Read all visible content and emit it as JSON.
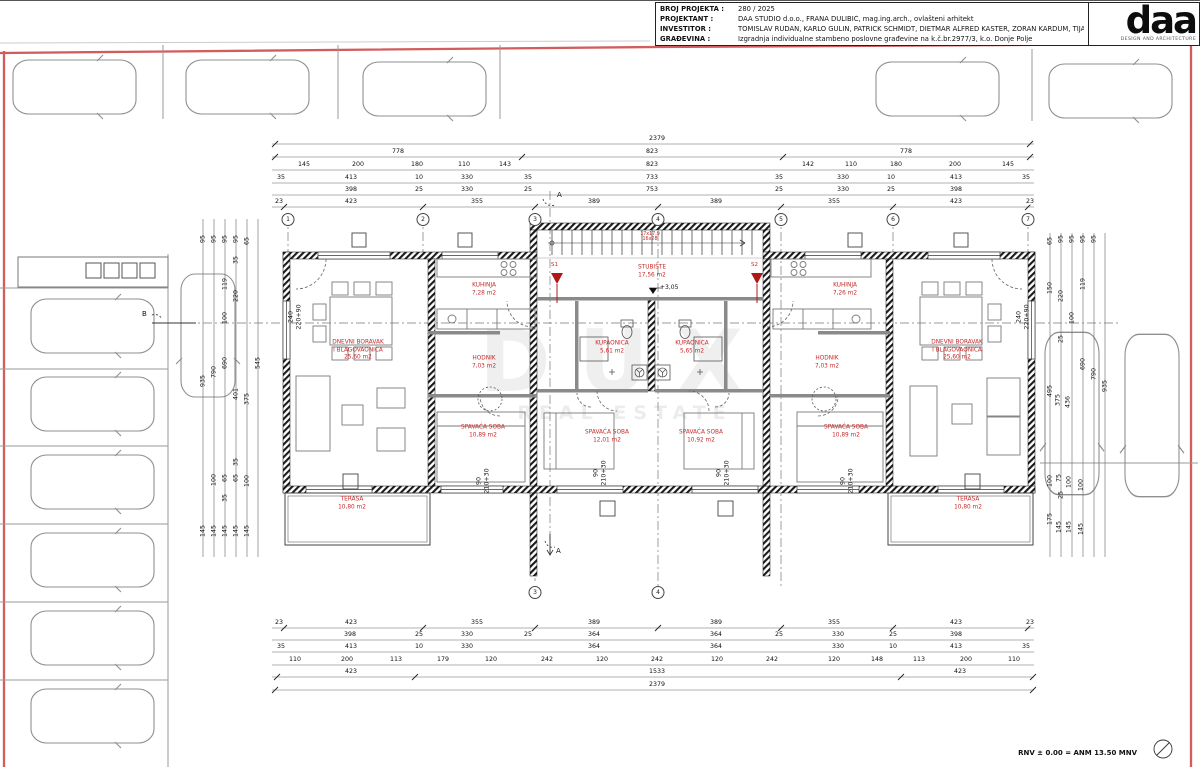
{
  "title_block": {
    "rows": [
      {
        "label": "BROJ PROJEKTA :",
        "value": "280 / 2025"
      },
      {
        "label": "PROJEKTANT :",
        "value": "DAA STUDIO d.o.o., FRANA DULIBIĆ, mag.ing.arch., ovlašteni arhitekt"
      },
      {
        "label": "INVESTITOR :",
        "value": "TOMISLAV RUDAN, KARLO GULIN, PATRICK SCHMIDT,  DIETMAR ALFRED KASTER, ZORAN KARDUM, TIJANA ERCEG"
      },
      {
        "label": "GRAĐEVINA :",
        "value": "Izgradnja individualne stambeno poslovne građevine na k.č.br.2977/3, k.o. Donje Polje"
      }
    ]
  },
  "logo": {
    "text": "daa",
    "subtext": "DESIGN AND ARCHITECTURE"
  },
  "colors": {
    "boundary_red": "#cc4b4b",
    "room_label_red": "#c62828",
    "wall_black": "#1a1a1a"
  },
  "watermark": {
    "line1": "DUX",
    "line2": "REAL ESTATE"
  },
  "footer": {
    "note": "RNV ± 0.00 = ANM 13.50 MNV"
  },
  "stair": {
    "note1": "17x17,9",
    "note2": "16x28",
    "level": "+3,05"
  },
  "markers": {
    "s1": "S1",
    "s2": "S2",
    "a_top": "A",
    "a_bottom": "A",
    "b": "B"
  },
  "rooms": [
    {
      "n1": "DNEVNI BORAVAK",
      "n2": "I BLAGOVAONICA",
      "a": "25,60 m2",
      "x": 358,
      "y": 350
    },
    {
      "n1": "KUHINJA",
      "n2": "",
      "a": "7,28 m2",
      "x": 484,
      "y": 289
    },
    {
      "n1": "HODNIK",
      "n2": "",
      "a": "7,03 m2",
      "x": 484,
      "y": 362
    },
    {
      "n1": "SPAVAĆA SOBA",
      "n2": "",
      "a": "10,89 m2",
      "x": 483,
      "y": 431
    },
    {
      "n1": "KUPAONICA",
      "n2": "",
      "a": "5,61 m2",
      "x": 612,
      "y": 347
    },
    {
      "n1": "KUPAONICA",
      "n2": "",
      "a": "5,65 m2",
      "x": 692,
      "y": 347
    },
    {
      "n1": "SPAVAĆA SOBA",
      "n2": "",
      "a": "12,01 m2",
      "x": 607,
      "y": 436
    },
    {
      "n1": "SPAVAĆA SOBA",
      "n2": "",
      "a": "10,92 m2",
      "x": 701,
      "y": 436
    },
    {
      "n1": "KUHINJA",
      "n2": "",
      "a": "7,26 m2",
      "x": 845,
      "y": 289
    },
    {
      "n1": "HODNIK",
      "n2": "",
      "a": "7,03 m2",
      "x": 827,
      "y": 362
    },
    {
      "n1": "SPAVAĆA SOBA",
      "n2": "",
      "a": "10,89 m2",
      "x": 846,
      "y": 431
    },
    {
      "n1": "DNEVNI BORAVAK",
      "n2": "I BLAGOVAONICA",
      "a": "25,60 m2",
      "x": 957,
      "y": 350
    },
    {
      "n1": "TERASA",
      "n2": "",
      "a": "10,80 m2",
      "x": 352,
      "y": 503
    },
    {
      "n1": "TERASA",
      "n2": "",
      "a": "10,80 m2",
      "x": 968,
      "y": 503
    },
    {
      "n1": "STUBIŠTE",
      "n2": "",
      "a": "17,56 m2",
      "x": 652,
      "y": 271
    }
  ],
  "grid_top": [
    {
      "n": "1",
      "x": 288,
      "y": 212
    },
    {
      "n": "2",
      "x": 423,
      "y": 212
    },
    {
      "n": "3",
      "x": 535,
      "y": 212
    },
    {
      "n": "4",
      "x": 658,
      "y": 212
    },
    {
      "n": "5",
      "x": 781,
      "y": 212
    },
    {
      "n": "6",
      "x": 893,
      "y": 212
    },
    {
      "n": "7",
      "x": 1028,
      "y": 212
    }
  ],
  "grid_bottom": [
    {
      "n": "3",
      "x": 535,
      "y": 585
    },
    {
      "n": "4",
      "x": 658,
      "y": 585
    }
  ],
  "dim_labels": [
    {
      "v": "2379",
      "x": 657,
      "y": 134
    },
    {
      "v": "778",
      "x": 398,
      "y": 147
    },
    {
      "v": "823",
      "x": 652,
      "y": 147
    },
    {
      "v": "778",
      "x": 906,
      "y": 147
    },
    {
      "v": "145",
      "x": 304,
      "y": 160
    },
    {
      "v": "200",
      "x": 358,
      "y": 160
    },
    {
      "v": "180",
      "x": 417,
      "y": 160
    },
    {
      "v": "110",
      "x": 464,
      "y": 160
    },
    {
      "v": "143",
      "x": 505,
      "y": 160
    },
    {
      "v": "823",
      "x": 652,
      "y": 160
    },
    {
      "v": "142",
      "x": 808,
      "y": 160
    },
    {
      "v": "110",
      "x": 851,
      "y": 160
    },
    {
      "v": "180",
      "x": 896,
      "y": 160
    },
    {
      "v": "200",
      "x": 955,
      "y": 160
    },
    {
      "v": "145",
      "x": 1008,
      "y": 160
    },
    {
      "v": "35",
      "x": 281,
      "y": 173
    },
    {
      "v": "413",
      "x": 351,
      "y": 173
    },
    {
      "v": "10",
      "x": 419,
      "y": 173
    },
    {
      "v": "330",
      "x": 467,
      "y": 173
    },
    {
      "v": "35",
      "x": 528,
      "y": 173
    },
    {
      "v": "733",
      "x": 652,
      "y": 173
    },
    {
      "v": "35",
      "x": 779,
      "y": 173
    },
    {
      "v": "330",
      "x": 843,
      "y": 173
    },
    {
      "v": "10",
      "x": 891,
      "y": 173
    },
    {
      "v": "413",
      "x": 956,
      "y": 173
    },
    {
      "v": "35",
      "x": 1026,
      "y": 173
    },
    {
      "v": "398",
      "x": 351,
      "y": 185
    },
    {
      "v": "25",
      "x": 419,
      "y": 185
    },
    {
      "v": "330",
      "x": 467,
      "y": 185
    },
    {
      "v": "25",
      "x": 528,
      "y": 185
    },
    {
      "v": "753",
      "x": 652,
      "y": 185
    },
    {
      "v": "25",
      "x": 779,
      "y": 185
    },
    {
      "v": "330",
      "x": 843,
      "y": 185
    },
    {
      "v": "25",
      "x": 891,
      "y": 185
    },
    {
      "v": "398",
      "x": 956,
      "y": 185
    },
    {
      "v": "23",
      "x": 279,
      "y": 197
    },
    {
      "v": "423",
      "x": 351,
      "y": 197
    },
    {
      "v": "355",
      "x": 477,
      "y": 197
    },
    {
      "v": "389",
      "x": 594,
      "y": 197
    },
    {
      "v": "389",
      "x": 716,
      "y": 197
    },
    {
      "v": "355",
      "x": 834,
      "y": 197
    },
    {
      "v": "423",
      "x": 956,
      "y": 197
    },
    {
      "v": "23",
      "x": 1030,
      "y": 197
    },
    {
      "v": "23",
      "x": 279,
      "y": 618
    },
    {
      "v": "423",
      "x": 351,
      "y": 618
    },
    {
      "v": "355",
      "x": 477,
      "y": 618
    },
    {
      "v": "389",
      "x": 594,
      "y": 618
    },
    {
      "v": "389",
      "x": 716,
      "y": 618
    },
    {
      "v": "355",
      "x": 834,
      "y": 618
    },
    {
      "v": "423",
      "x": 956,
      "y": 618
    },
    {
      "v": "23",
      "x": 1030,
      "y": 618
    },
    {
      "v": "398",
      "x": 350,
      "y": 630
    },
    {
      "v": "25",
      "x": 419,
      "y": 630
    },
    {
      "v": "330",
      "x": 467,
      "y": 630
    },
    {
      "v": "25",
      "x": 528,
      "y": 630
    },
    {
      "v": "364",
      "x": 594,
      "y": 630
    },
    {
      "v": "364",
      "x": 716,
      "y": 630
    },
    {
      "v": "25",
      "x": 779,
      "y": 630
    },
    {
      "v": "330",
      "x": 838,
      "y": 630
    },
    {
      "v": "25",
      "x": 893,
      "y": 630
    },
    {
      "v": "398",
      "x": 956,
      "y": 630
    },
    {
      "v": "35",
      "x": 281,
      "y": 642
    },
    {
      "v": "413",
      "x": 351,
      "y": 642
    },
    {
      "v": "10",
      "x": 419,
      "y": 642
    },
    {
      "v": "330",
      "x": 467,
      "y": 642
    },
    {
      "v": "364",
      "x": 594,
      "y": 642
    },
    {
      "v": "364",
      "x": 716,
      "y": 642
    },
    {
      "v": "330",
      "x": 838,
      "y": 642
    },
    {
      "v": "10",
      "x": 893,
      "y": 642
    },
    {
      "v": "413",
      "x": 956,
      "y": 642
    },
    {
      "v": "35",
      "x": 1026,
      "y": 642
    },
    {
      "v": "110",
      "x": 295,
      "y": 655
    },
    {
      "v": "200",
      "x": 347,
      "y": 655
    },
    {
      "v": "113",
      "x": 396,
      "y": 655
    },
    {
      "v": "179",
      "x": 443,
      "y": 655
    },
    {
      "v": "120",
      "x": 491,
      "y": 655
    },
    {
      "v": "242",
      "x": 547,
      "y": 655
    },
    {
      "v": "120",
      "x": 602,
      "y": 655
    },
    {
      "v": "242",
      "x": 657,
      "y": 655
    },
    {
      "v": "120",
      "x": 717,
      "y": 655
    },
    {
      "v": "242",
      "x": 772,
      "y": 655
    },
    {
      "v": "120",
      "x": 834,
      "y": 655
    },
    {
      "v": "148",
      "x": 877,
      "y": 655
    },
    {
      "v": "113",
      "x": 919,
      "y": 655
    },
    {
      "v": "200",
      "x": 966,
      "y": 655
    },
    {
      "v": "110",
      "x": 1014,
      "y": 655
    },
    {
      "v": "423",
      "x": 351,
      "y": 667
    },
    {
      "v": "1533",
      "x": 657,
      "y": 667
    },
    {
      "v": "423",
      "x": 960,
      "y": 667
    },
    {
      "v": "2379",
      "x": 657,
      "y": 680
    },
    {
      "v": "95",
      "x": 203,
      "y": 238,
      "r": 1
    },
    {
      "v": "95",
      "x": 214,
      "y": 238,
      "r": 1
    },
    {
      "v": "95",
      "x": 225,
      "y": 238,
      "r": 1
    },
    {
      "v": "95",
      "x": 236,
      "y": 238,
      "r": 1
    },
    {
      "v": "65",
      "x": 247,
      "y": 240,
      "r": 1
    },
    {
      "v": "35",
      "x": 236,
      "y": 259,
      "r": 1
    },
    {
      "v": "119",
      "x": 225,
      "y": 283,
      "r": 1
    },
    {
      "v": "220",
      "x": 236,
      "y": 295,
      "r": 1
    },
    {
      "v": "100",
      "x": 225,
      "y": 317,
      "r": 1
    },
    {
      "v": "545",
      "x": 258,
      "y": 362,
      "r": 1
    },
    {
      "v": "690",
      "x": 225,
      "y": 362,
      "r": 1
    },
    {
      "v": "790",
      "x": 214,
      "y": 371,
      "r": 1
    },
    {
      "v": "935",
      "x": 203,
      "y": 380,
      "r": 1
    },
    {
      "v": "401",
      "x": 236,
      "y": 393,
      "r": 1
    },
    {
      "v": "375",
      "x": 247,
      "y": 398,
      "r": 1
    },
    {
      "v": "35",
      "x": 236,
      "y": 461,
      "r": 1
    },
    {
      "v": "100",
      "x": 214,
      "y": 479,
      "r": 1
    },
    {
      "v": "65",
      "x": 225,
      "y": 477,
      "r": 1
    },
    {
      "v": "65",
      "x": 236,
      "y": 477,
      "r": 1
    },
    {
      "v": "100",
      "x": 247,
      "y": 480,
      "r": 1
    },
    {
      "v": "35",
      "x": 225,
      "y": 497,
      "r": 1
    },
    {
      "v": "145",
      "x": 203,
      "y": 530,
      "r": 1
    },
    {
      "v": "145",
      "x": 214,
      "y": 530,
      "r": 1
    },
    {
      "v": "145",
      "x": 225,
      "y": 530,
      "r": 1
    },
    {
      "v": "145",
      "x": 236,
      "y": 530,
      "r": 1
    },
    {
      "v": "145",
      "x": 247,
      "y": 530,
      "r": 1
    },
    {
      "v": "65",
      "x": 1050,
      "y": 240,
      "r": 1
    },
    {
      "v": "95",
      "x": 1061,
      "y": 238,
      "r": 1
    },
    {
      "v": "95",
      "x": 1072,
      "y": 238,
      "r": 1
    },
    {
      "v": "95",
      "x": 1083,
      "y": 238,
      "r": 1
    },
    {
      "v": "95",
      "x": 1094,
      "y": 238,
      "r": 1
    },
    {
      "v": "150",
      "x": 1050,
      "y": 287,
      "r": 1
    },
    {
      "v": "220",
      "x": 1061,
      "y": 295,
      "r": 1
    },
    {
      "v": "100",
      "x": 1072,
      "y": 317,
      "r": 1
    },
    {
      "v": "119",
      "x": 1083,
      "y": 283,
      "r": 1
    },
    {
      "v": "25",
      "x": 1061,
      "y": 338,
      "r": 1
    },
    {
      "v": "495",
      "x": 1050,
      "y": 390,
      "r": 1
    },
    {
      "v": "375",
      "x": 1058,
      "y": 399,
      "r": 1
    },
    {
      "v": "436",
      "x": 1068,
      "y": 401,
      "r": 1
    },
    {
      "v": "690",
      "x": 1083,
      "y": 363,
      "r": 1
    },
    {
      "v": "790",
      "x": 1094,
      "y": 373,
      "r": 1
    },
    {
      "v": "935",
      "x": 1105,
      "y": 385,
      "r": 1
    },
    {
      "v": "100",
      "x": 1050,
      "y": 480,
      "r": 1
    },
    {
      "v": "75",
      "x": 1059,
      "y": 477,
      "r": 1
    },
    {
      "v": "100",
      "x": 1069,
      "y": 481,
      "r": 1
    },
    {
      "v": "100",
      "x": 1081,
      "y": 484,
      "r": 1
    },
    {
      "v": "25",
      "x": 1061,
      "y": 494,
      "r": 1
    },
    {
      "v": "175",
      "x": 1050,
      "y": 518,
      "r": 1
    },
    {
      "v": "145",
      "x": 1059,
      "y": 526,
      "r": 1
    },
    {
      "v": "145",
      "x": 1069,
      "y": 526,
      "r": 1
    },
    {
      "v": "145",
      "x": 1081,
      "y": 528,
      "r": 1
    },
    {
      "v": "90",
      "x": 479,
      "y": 480,
      "r": 1
    },
    {
      "v": "210+30",
      "x": 487,
      "y": 480,
      "r": 1
    },
    {
      "v": "90",
      "x": 596,
      "y": 472,
      "r": 1
    },
    {
      "v": "210+30",
      "x": 604,
      "y": 472,
      "r": 1
    },
    {
      "v": "90",
      "x": 719,
      "y": 472,
      "r": 1
    },
    {
      "v": "210+30",
      "x": 727,
      "y": 472,
      "r": 1
    },
    {
      "v": "90",
      "x": 843,
      "y": 480,
      "r": 1
    },
    {
      "v": "210+30",
      "x": 851,
      "y": 480,
      "r": 1
    },
    {
      "v": "240",
      "x": 291,
      "y": 316,
      "r": 1
    },
    {
      "v": "220+90",
      "x": 299,
      "y": 316,
      "r": 1
    },
    {
      "v": "240",
      "x": 1019,
      "y": 316,
      "r": 1
    },
    {
      "v": "220+90",
      "x": 1027,
      "y": 316,
      "r": 1
    }
  ]
}
